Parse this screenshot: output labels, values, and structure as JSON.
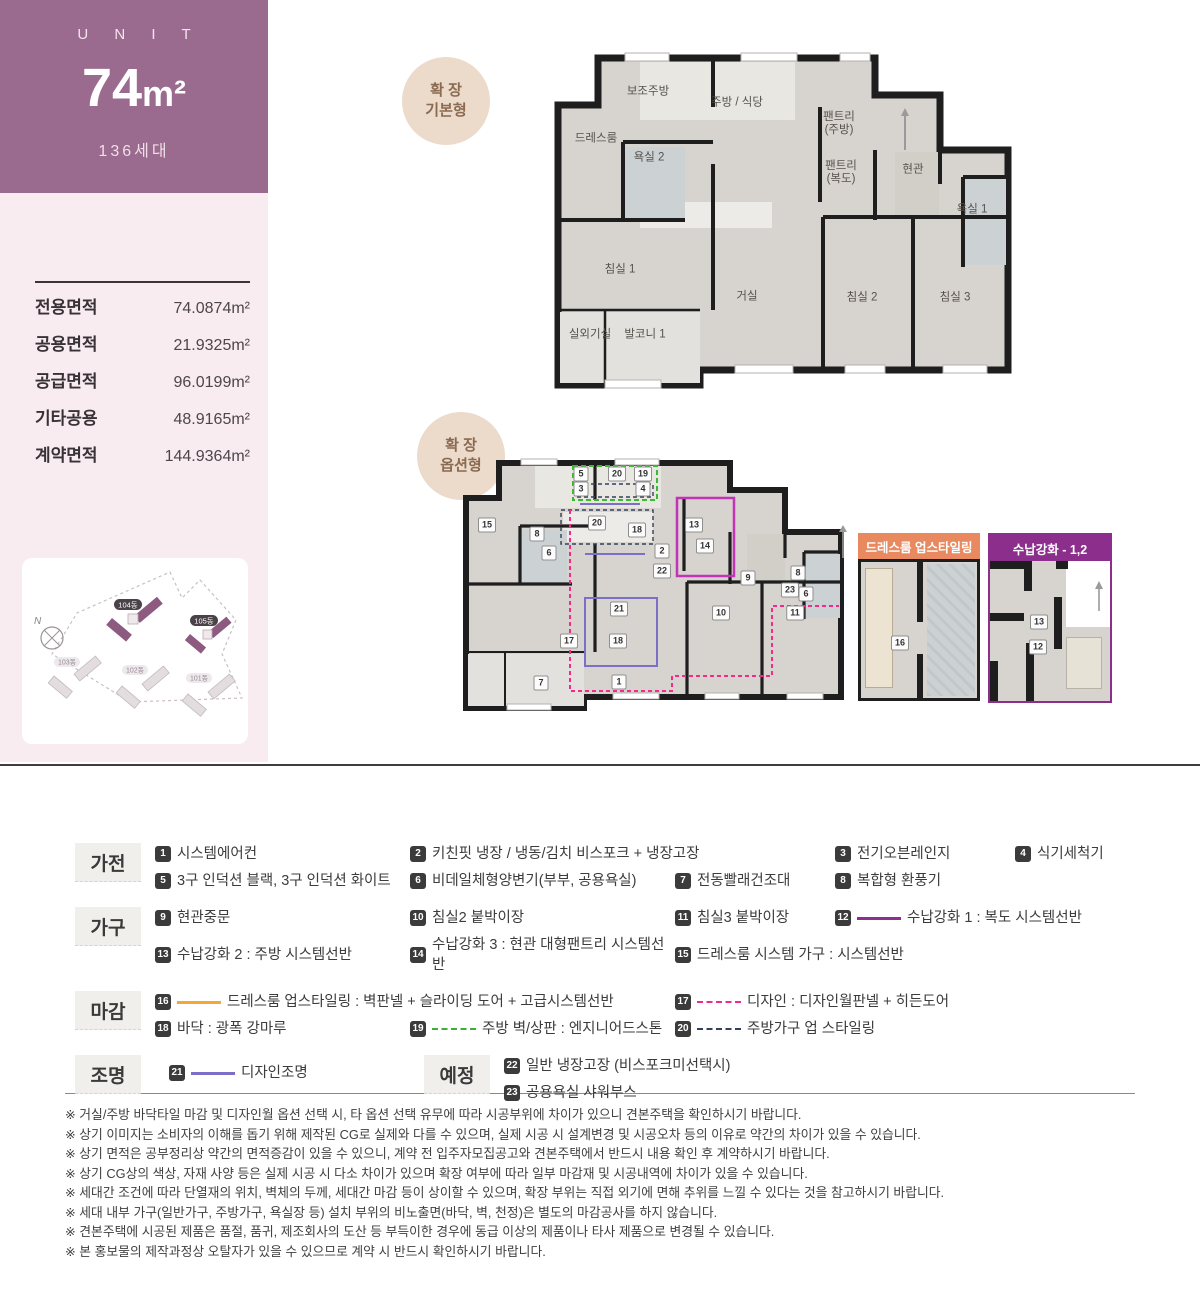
{
  "unit": {
    "label": "U N I T",
    "size_num": "74",
    "size_unit": "m²",
    "households": "136세대"
  },
  "areas": {
    "rows": [
      {
        "label": "전용면적",
        "value": "74.0874m²"
      },
      {
        "label": "공용면적",
        "value": "21.9325m²"
      },
      {
        "label": "공급면적",
        "value": "96.0199m²"
      },
      {
        "label": "기타공용",
        "value": "48.9165m²"
      },
      {
        "label": "계약면적",
        "value": "144.9364m²"
      }
    ]
  },
  "site": {
    "compass": "N",
    "buildings": [
      {
        "name": "104동",
        "highlight": true
      },
      {
        "name": "105동",
        "highlight": true
      },
      {
        "name": "103동",
        "highlight": false
      },
      {
        "name": "102동",
        "highlight": false
      },
      {
        "name": "101동",
        "highlight": false
      }
    ]
  },
  "plans": {
    "basic": {
      "badge": "확 장\n기본형",
      "rooms": [
        "보조주방",
        "주방 / 식당",
        "드레스룸",
        "욕실 2",
        "팬트리\n(주방)",
        "현관",
        "팬트리\n(복도)",
        "욕실 1",
        "침실 1",
        "거실",
        "침실 2",
        "침실 3",
        "실외기실",
        "발코니 1"
      ]
    },
    "option": {
      "badge": "확 장\n옵션형",
      "markers": [
        "5",
        "20",
        "19",
        "3",
        "4",
        "15",
        "8",
        "6",
        "20",
        "18",
        "2",
        "22",
        "13",
        "14",
        "9",
        "8",
        "23",
        "6",
        "10",
        "11",
        "21",
        "17",
        "18",
        "1",
        "7"
      ]
    }
  },
  "detail_panels": [
    {
      "title": "드레스룸 업스타일링",
      "markers": [
        "16"
      ]
    },
    {
      "title": "수납강화 - 1,2",
      "markers": [
        "13",
        "12"
      ]
    }
  ],
  "legend": {
    "categories": [
      "가전",
      "가구",
      "마감",
      "조명"
    ],
    "planned_label": "예정",
    "items": [
      {
        "n": "1",
        "text": "시스템에어컨"
      },
      {
        "n": "2",
        "text": "키친핏 냉장 / 냉동/김치 비스포크 + 냉장고장"
      },
      {
        "n": "3",
        "text": "전기오븐레인지"
      },
      {
        "n": "4",
        "text": "식기세척기"
      },
      {
        "n": "5",
        "text": "3구 인덕션 블랙, 3구 인덕션 화이트"
      },
      {
        "n": "6",
        "text": "비데일체형양변기(부부, 공용욕실)"
      },
      {
        "n": "7",
        "text": "전동빨래건조대"
      },
      {
        "n": "8",
        "text": "복합형 환풍기"
      },
      {
        "n": "9",
        "text": "현관중문"
      },
      {
        "n": "10",
        "text": "침실2 붙박이장"
      },
      {
        "n": "11",
        "text": "침실3 붙박이장"
      },
      {
        "n": "12",
        "text": "수납강화 1 : 복도 시스템선반"
      },
      {
        "n": "13",
        "text": "수납강화 2 : 주방 시스템선반"
      },
      {
        "n": "14",
        "text": "수납강화 3 : 현관 대형팬트리 시스템선반"
      },
      {
        "n": "15",
        "text": "드레스룸 시스템 가구 : 시스템선반"
      },
      {
        "n": "16",
        "text": "드레스룸 업스타일링 : 벽판넬 + 슬라이딩 도어 + 고급시스템선반"
      },
      {
        "n": "17",
        "text": "디자인 : 디자인월판넬 + 히든도어"
      },
      {
        "n": "18",
        "text": "바닥 : 광폭 강마루"
      },
      {
        "n": "19",
        "text": "주방 벽/상판 : 엔지니어드스톤"
      },
      {
        "n": "20",
        "text": "주방가구 업 스타일링"
      },
      {
        "n": "21",
        "text": "디자인조명"
      }
    ],
    "planned_items": [
      {
        "n": "22",
        "text": "일반 냉장고장 (비스포크미선택시)"
      },
      {
        "n": "23",
        "text": "공용욕실 샤워부스"
      }
    ]
  },
  "colors": {
    "accent_purple": "#9a6b8e",
    "sidebar_pink": "#f8ecf1",
    "badge_circle": "#ecdacb",
    "detail1_header": "#e8895f",
    "detail2_header": "#8c2e8c",
    "swatch_12": "#8c2f90",
    "swatch_16": "#f5a733",
    "swatch_17": "#f5288c",
    "swatch_19": "#3cb02f",
    "swatch_20": "#33415c",
    "swatch_21": "#7b6fc8",
    "plan_wall": "#1e1e1e",
    "plan_floor": "#d7d3ce"
  },
  "footnotes": [
    "※ 거실/주방 바닥타일 마감 및 디자인월 옵션 선택 시, 타 옵션 선택 유무에 따라 시공부위에 차이가 있으니 견본주택을 확인하시기 바랍니다.",
    "※ 상기 이미지는 소비자의 이해를 돕기 위해 제작된 CG로 실제와 다를 수 있으며, 실제 시공 시 설계변경 및 시공오차 등의 이유로 약간의 차이가 있을 수 있습니다.",
    "※ 상기 면적은 공부정리상 약간의 면적증감이 있을 수 있으니, 계약 전 입주자모집공고와 견본주택에서 반드시 내용 확인 후 계약하시기 바랍니다.",
    "※ 상기 CG상의 색상, 자재 사양 등은 실제 시공 시 다소 차이가 있으며 확장 여부에 따라 일부 마감재 및 시공내역에 차이가 있을 수 있습니다.",
    "※ 세대간 조건에 따라 단열재의 위치, 벽체의 두께, 세대간 마감 등이 상이할 수 있으며, 확장 부위는 직접 외기에 면해 추위를 느낄 수 있다는 것을 참고하시기 바랍니다.",
    "※ 세대 내부 가구(일반가구, 주방가구, 욕실장 등) 설치 부위의 비노출면(바닥, 벽, 천정)은 별도의 마감공사를 하지 않습니다.",
    "※ 견본주택에 시공된 제품은 품절, 품귀, 제조회사의 도산 등 부득이한 경우에 동급 이상의 제품이나 타사 제품으로 변경될 수 있습니다.",
    "※ 본 홍보물의 제작과정상 오탈자가 있을 수 있으므로 계약 시 반드시 확인하시기 바랍니다."
  ]
}
